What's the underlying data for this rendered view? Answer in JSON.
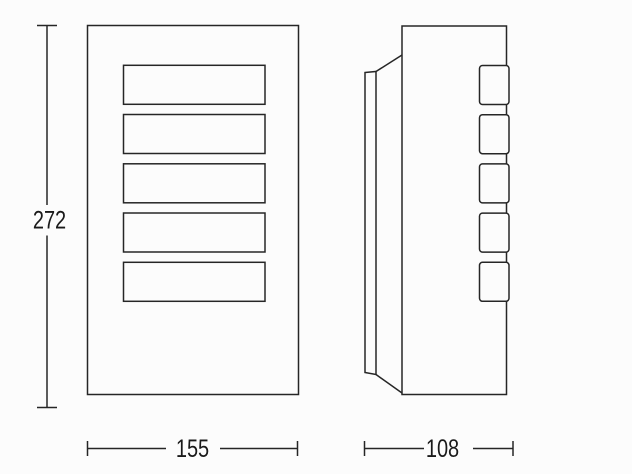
{
  "drawing": {
    "type": "technical-dimension-drawing",
    "views": {
      "front": "front-view",
      "side": "side-view"
    },
    "dimensions": {
      "height": "272",
      "width": "155",
      "depth": "108"
    },
    "colors": {
      "line": "#262626",
      "background": "#fcfcfc",
      "text": "#1a1a1a"
    }
  }
}
